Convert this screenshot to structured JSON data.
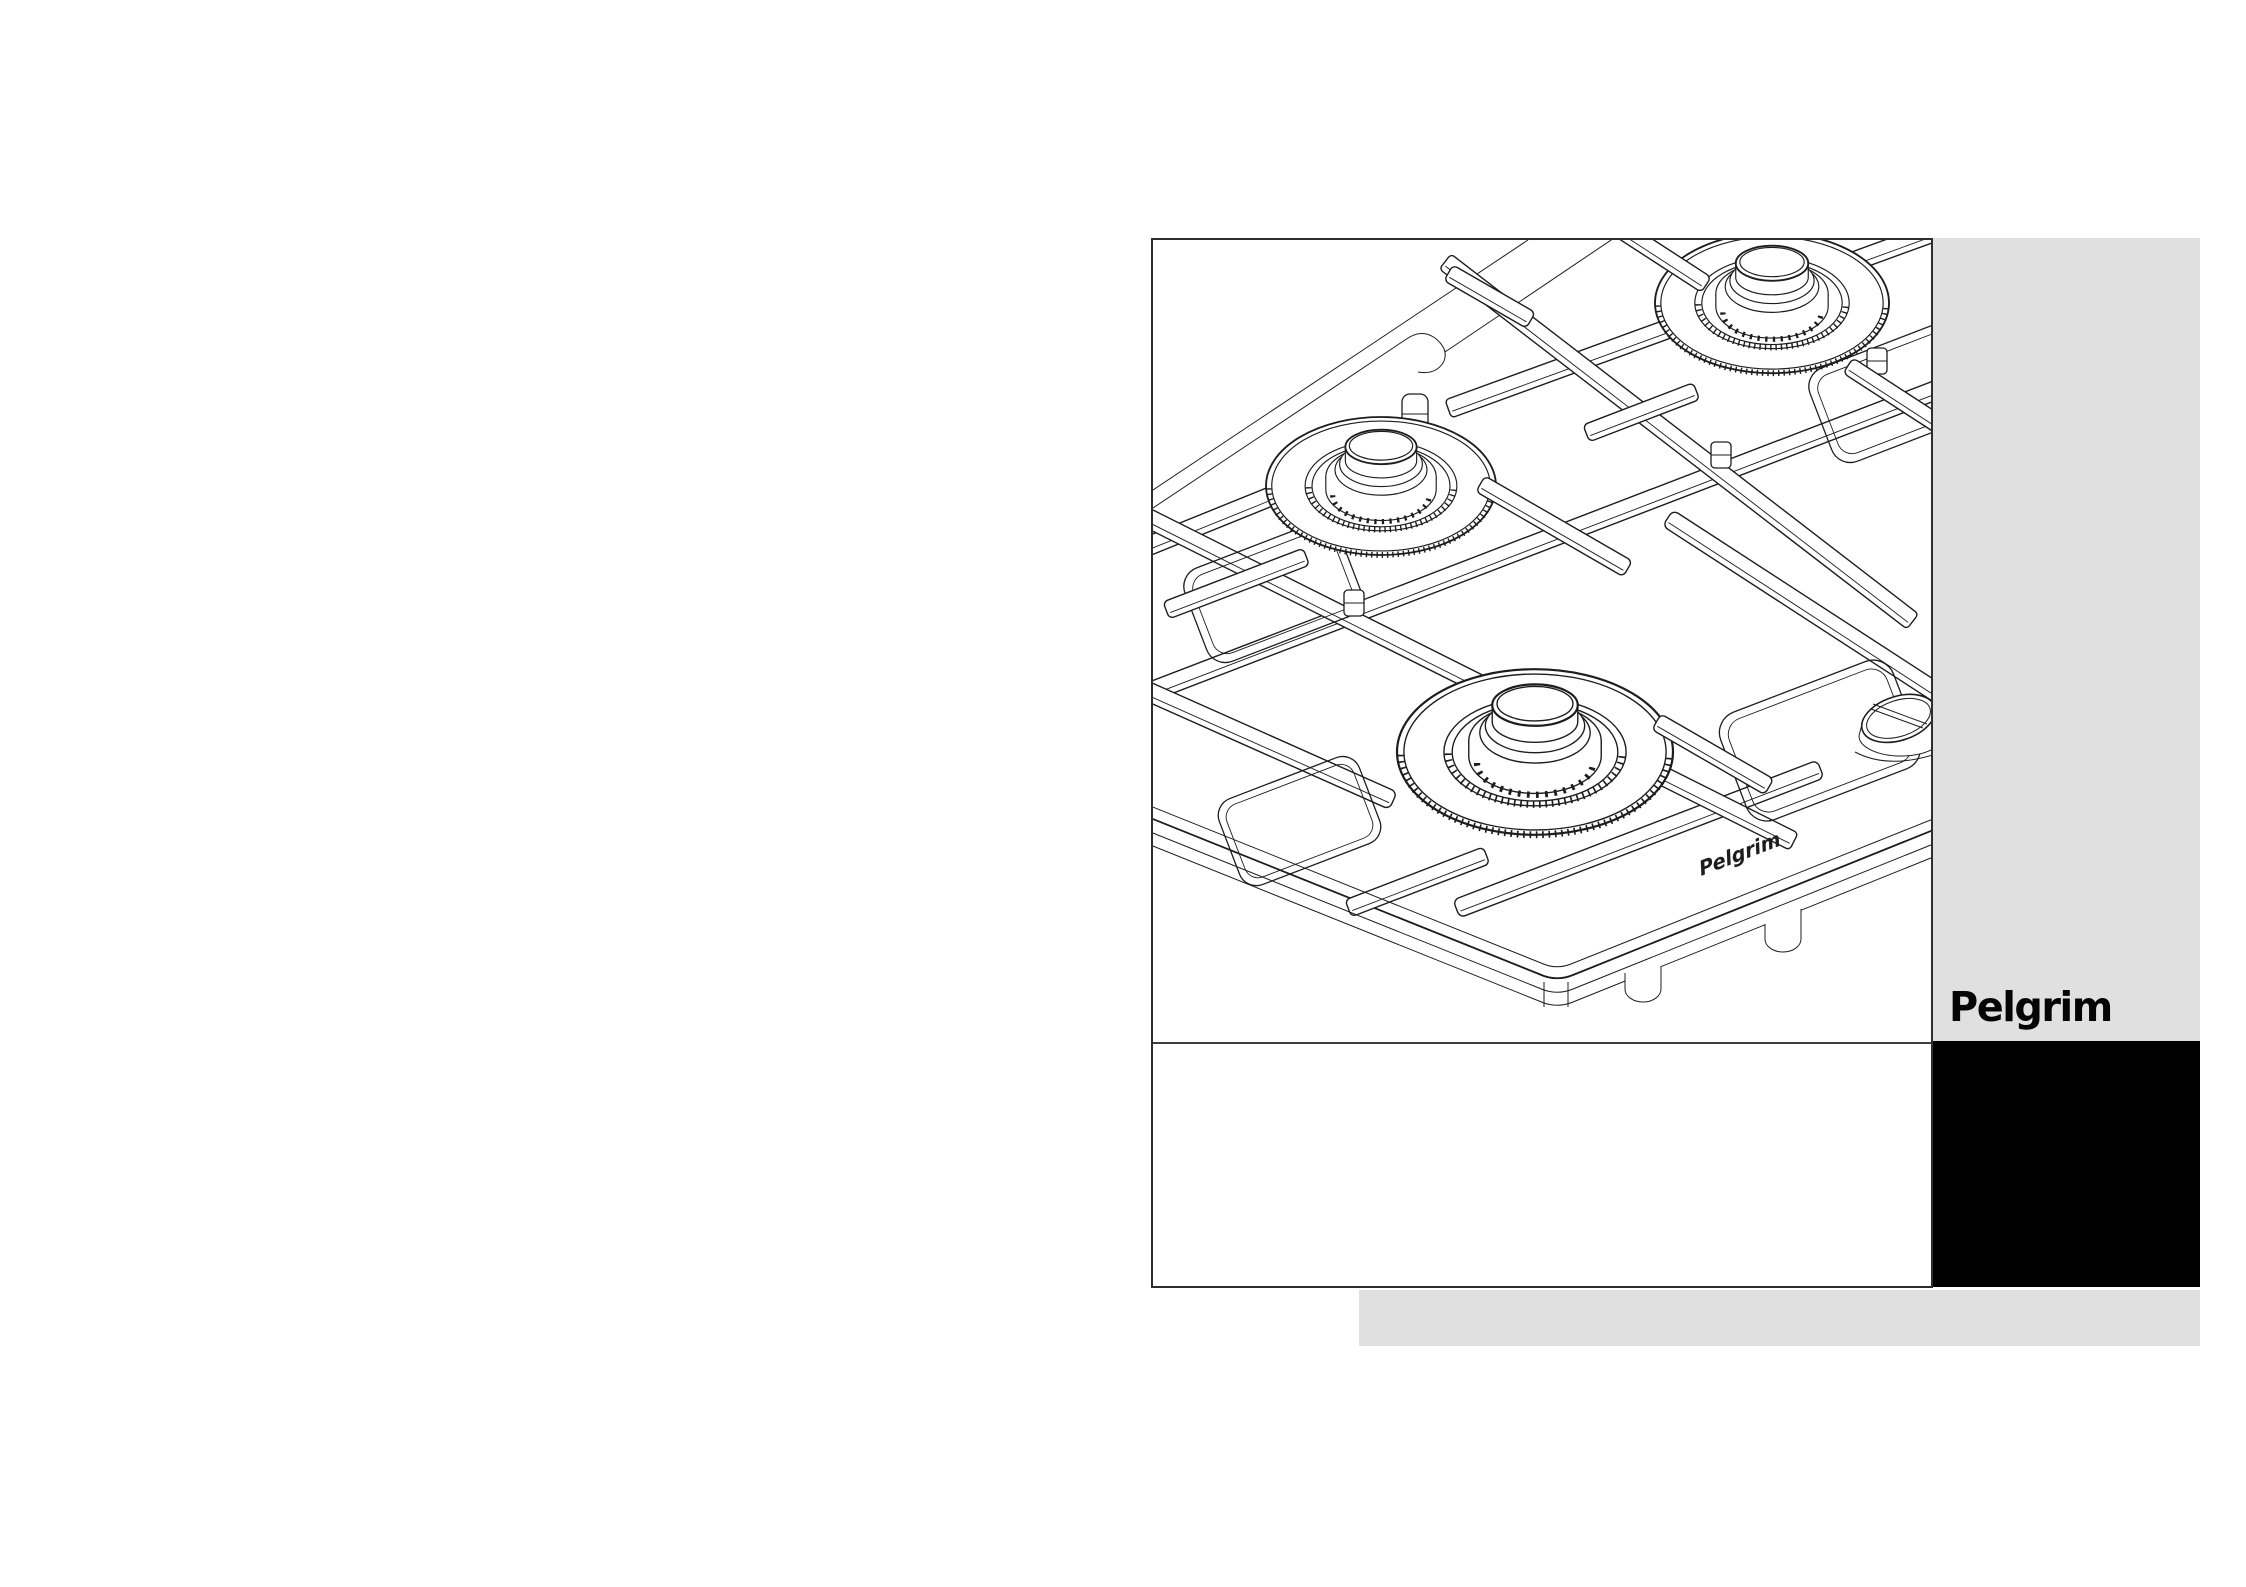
{
  "cover": {
    "brand_logo": "Pelgrim",
    "hob_print": "Pelgrim"
  },
  "colors": {
    "page_background": "#ffffff",
    "panel_gray": "#e0e0e0",
    "panel_black": "#000000",
    "frame_border": "#2e2e2e",
    "line_art": "#1d1d1d"
  },
  "illustration": {
    "label": "isometric line drawing of a built-in gas hob with pan supports, three visible burners and a control knob"
  }
}
